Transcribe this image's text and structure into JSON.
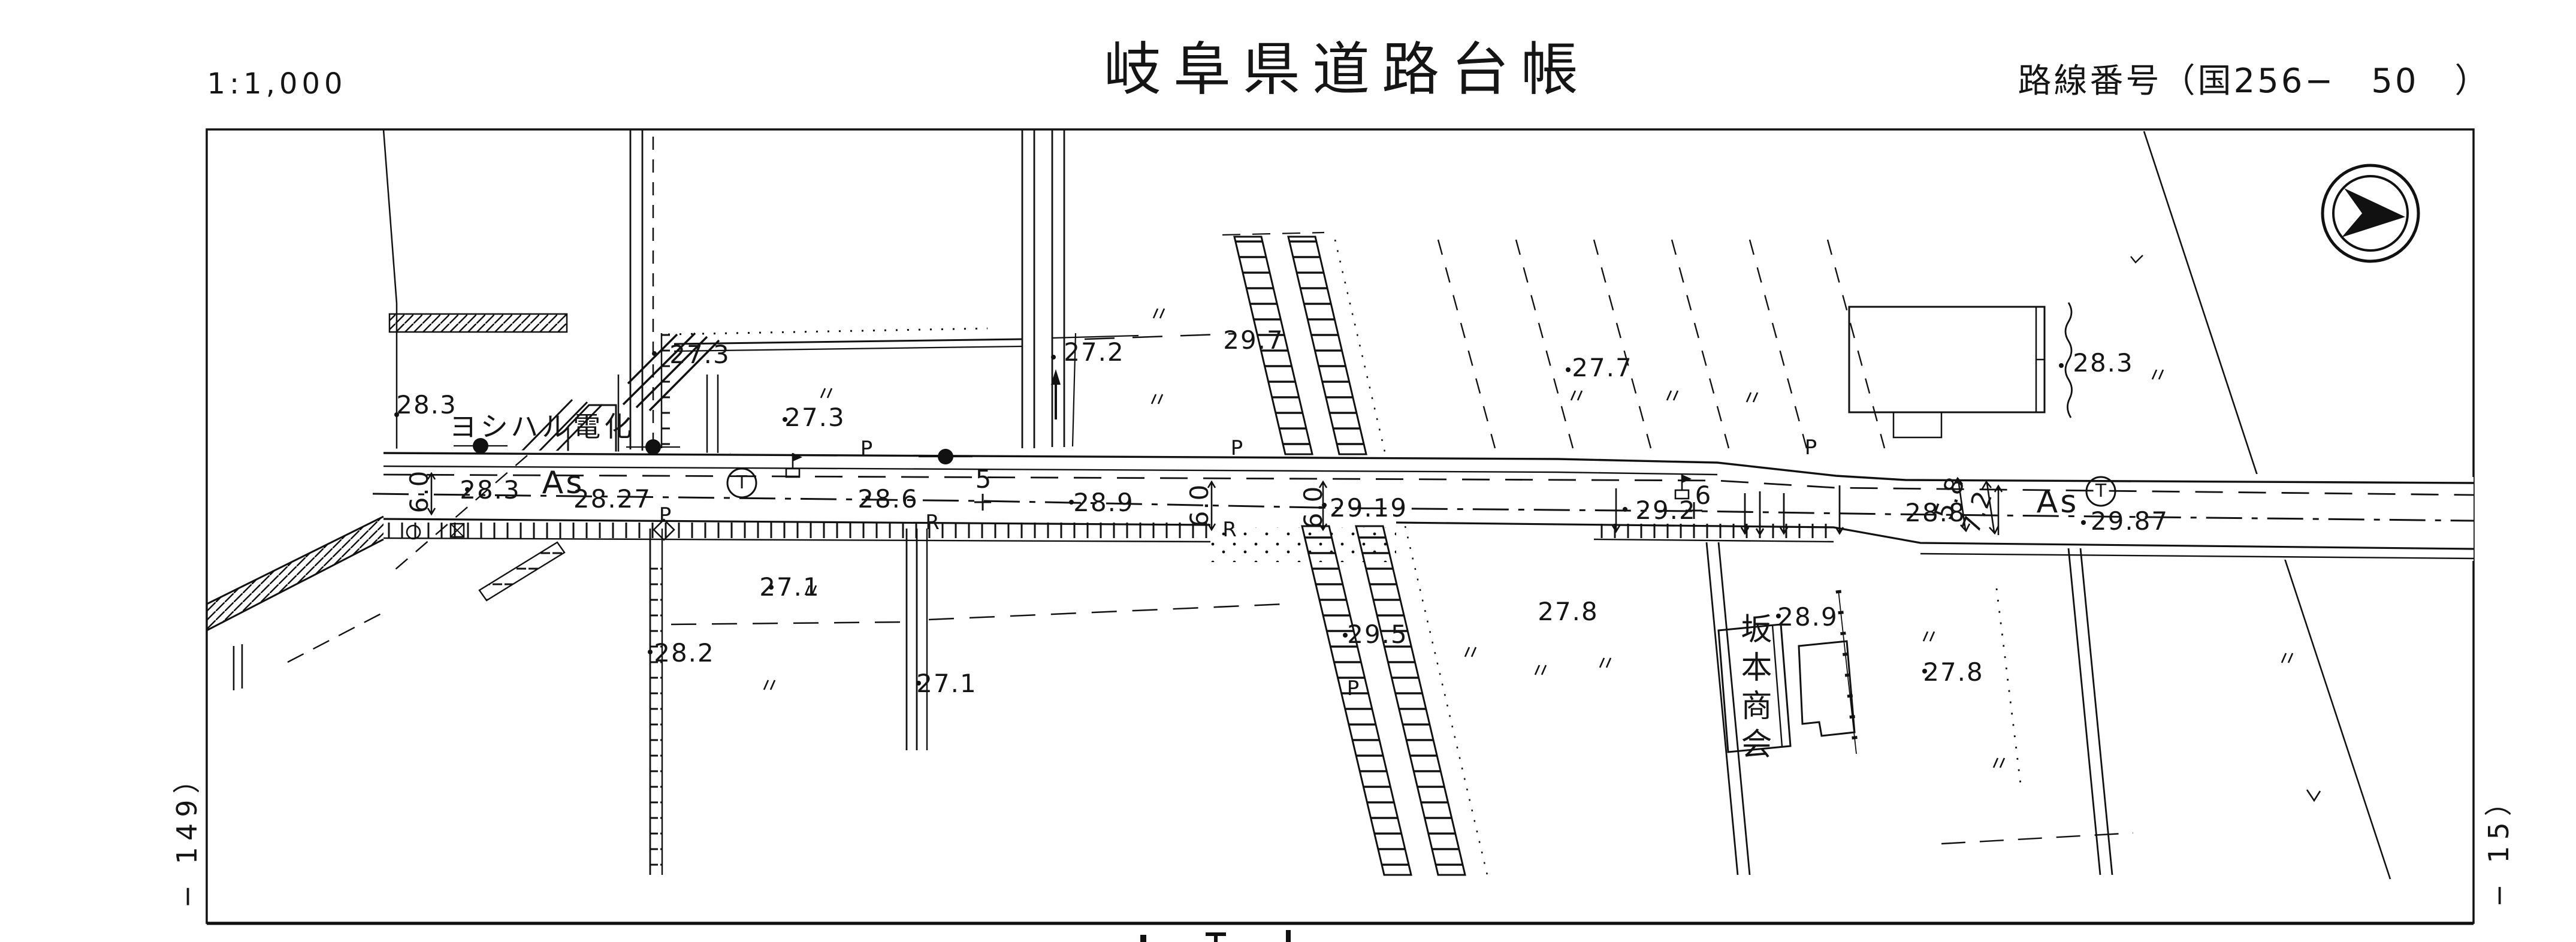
{
  "header": {
    "scale": "1:1,000",
    "title": "岐阜県道路台帳",
    "route_label": "路線番号（国256−　50　）"
  },
  "margins": {
    "left_note": "− 149）",
    "right_note": "− 15）"
  },
  "map": {
    "elevations": [
      "28.3",
      "27.3",
      "27.3",
      "27.2",
      "29.7",
      "27.7",
      "28.3",
      "28.3",
      "28.27",
      "28.6",
      "28.9",
      "29.19",
      "29.2",
      "28.8",
      "29.87",
      "27.1",
      "28.2",
      "27.1",
      "29.5",
      "27.8",
      "28.9",
      "27.8"
    ],
    "widths": [
      "6.0",
      "6.0",
      "6.0",
      "5.8",
      "7.2"
    ],
    "stations": [
      "5",
      "6"
    ],
    "surfaces": [
      "As",
      "As"
    ],
    "corner_marks": [
      "R",
      "R"
    ],
    "pole_marks": [
      "P",
      "P",
      "P",
      "P",
      "P"
    ],
    "circled_marks": [
      "T",
      "T"
    ],
    "businesses": [
      "ヨシハル電化",
      "坂本商会"
    ]
  }
}
